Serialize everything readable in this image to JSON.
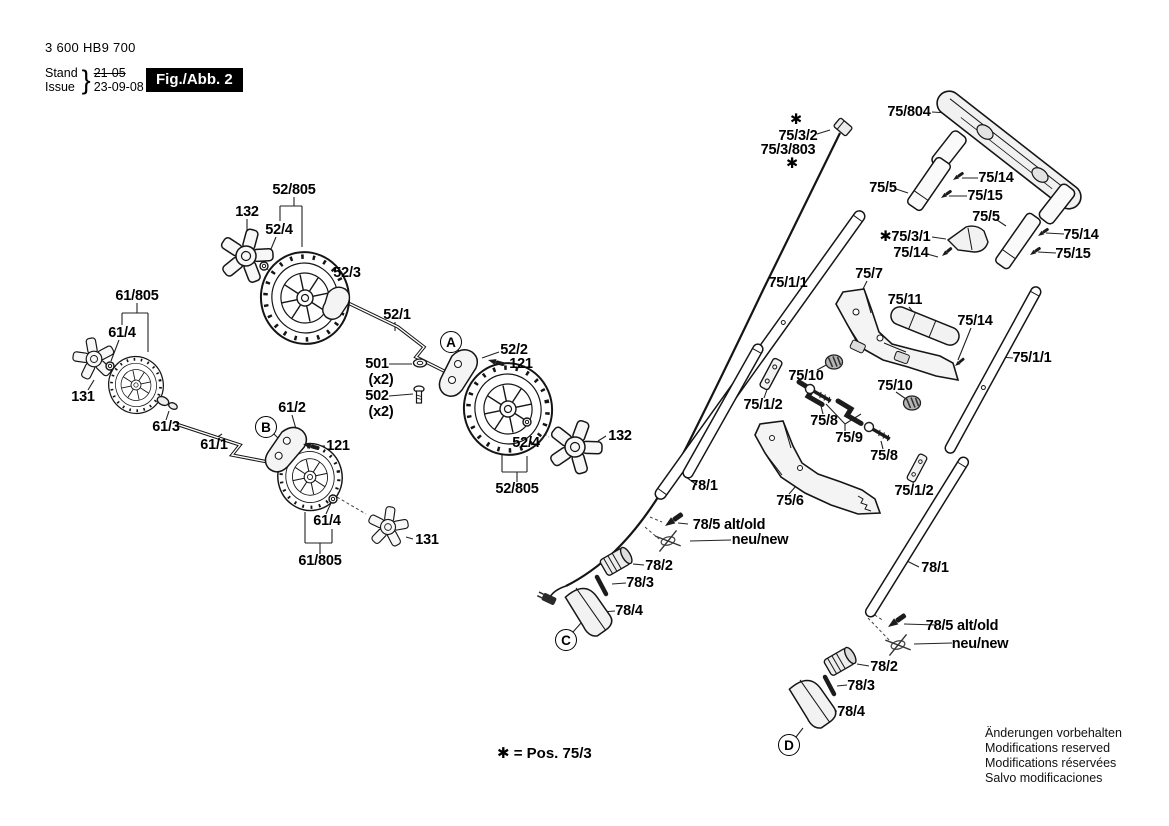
{
  "header": {
    "part_number": "3 600 HB9 700",
    "stand_label": "Stand",
    "issue_label": "Issue",
    "brace": "}",
    "stand_value": "21-05",
    "issue_value": "23-09-08",
    "figure_label": "Fig./Abb. 2"
  },
  "footnote": "✱ = Pos. 75/3",
  "disclaimer": [
    "Änderungen vorbehalten",
    "Modifications reserved",
    "Modifications réservées",
    "Salvo modificaciones"
  ],
  "colors": {
    "ink": "#151515",
    "label_text": "#000000",
    "fig_box_bg": "#000000",
    "fig_box_text": "#ffffff"
  },
  "callouts": [
    {
      "text": "A",
      "x": 451,
      "y": 342
    },
    {
      "text": "B",
      "x": 266,
      "y": 427
    },
    {
      "text": "C",
      "x": 566,
      "y": 640
    },
    {
      "text": "D",
      "x": 789,
      "y": 745
    }
  ],
  "labels": [
    {
      "text": "52/805",
      "x": 294,
      "y": 190
    },
    {
      "text": "132",
      "x": 247,
      "y": 212
    },
    {
      "text": "52/4",
      "x": 279,
      "y": 230
    },
    {
      "text": "52/3",
      "x": 347,
      "y": 273
    },
    {
      "text": "52/1",
      "x": 397,
      "y": 315
    },
    {
      "text": "501",
      "x": 377,
      "y": 364
    },
    {
      "text": "(x2)",
      "x": 381,
      "y": 380
    },
    {
      "text": "502",
      "x": 377,
      "y": 396
    },
    {
      "text": "(x2)",
      "x": 381,
      "y": 412
    },
    {
      "text": "52/2",
      "x": 514,
      "y": 350
    },
    {
      "text": "121",
      "x": 521,
      "y": 364
    },
    {
      "text": "61/805",
      "x": 137,
      "y": 296
    },
    {
      "text": "61/4",
      "x": 122,
      "y": 333
    },
    {
      "text": "131",
      "x": 83,
      "y": 397
    },
    {
      "text": "61/3",
      "x": 166,
      "y": 427
    },
    {
      "text": "61/1",
      "x": 214,
      "y": 445
    },
    {
      "text": "61/2",
      "x": 292,
      "y": 408
    },
    {
      "text": "121",
      "x": 338,
      "y": 446
    },
    {
      "text": "52/4",
      "x": 526,
      "y": 443
    },
    {
      "text": "132",
      "x": 620,
      "y": 436
    },
    {
      "text": "52/805",
      "x": 517,
      "y": 489
    },
    {
      "text": "61/4",
      "x": 327,
      "y": 521
    },
    {
      "text": "131",
      "x": 427,
      "y": 540
    },
    {
      "text": "61/805",
      "x": 320,
      "y": 561
    },
    {
      "text": "✱",
      "x": 796,
      "y": 120
    },
    {
      "text": "75/3/2",
      "x": 798,
      "y": 136
    },
    {
      "text": "75/3/803",
      "x": 788,
      "y": 150
    },
    {
      "text": "✱",
      "x": 792,
      "y": 164
    },
    {
      "text": "75/804",
      "x": 909,
      "y": 112
    },
    {
      "text": "75/5",
      "x": 883,
      "y": 188
    },
    {
      "text": "75/14",
      "x": 996,
      "y": 178
    },
    {
      "text": "75/15",
      "x": 985,
      "y": 196
    },
    {
      "text": "✱75/3/1",
      "x": 905,
      "y": 237
    },
    {
      "text": "75/14",
      "x": 911,
      "y": 253
    },
    {
      "text": "75/5",
      "x": 986,
      "y": 217
    },
    {
      "text": "75/14",
      "x": 1081,
      "y": 235
    },
    {
      "text": "75/15",
      "x": 1073,
      "y": 254
    },
    {
      "text": "75/1/1",
      "x": 788,
      "y": 283
    },
    {
      "text": "75/7",
      "x": 869,
      "y": 274
    },
    {
      "text": "75/11",
      "x": 905,
      "y": 300
    },
    {
      "text": "75/14",
      "x": 975,
      "y": 321
    },
    {
      "text": "75/1/1",
      "x": 1032,
      "y": 358
    },
    {
      "text": "75/10",
      "x": 806,
      "y": 376
    },
    {
      "text": "75/10",
      "x": 895,
      "y": 386
    },
    {
      "text": "75/1/2",
      "x": 763,
      "y": 405
    },
    {
      "text": "75/8",
      "x": 824,
      "y": 421
    },
    {
      "text": "75/9",
      "x": 849,
      "y": 438
    },
    {
      "text": "75/8",
      "x": 884,
      "y": 456
    },
    {
      "text": "78/1",
      "x": 704,
      "y": 486
    },
    {
      "text": "75/6",
      "x": 790,
      "y": 501
    },
    {
      "text": "75/1/2",
      "x": 914,
      "y": 491
    },
    {
      "text": "78/5 alt/old",
      "x": 729,
      "y": 525
    },
    {
      "text": "neu/new",
      "x": 760,
      "y": 540
    },
    {
      "text": "78/2",
      "x": 659,
      "y": 566
    },
    {
      "text": "78/3",
      "x": 640,
      "y": 583
    },
    {
      "text": "78/4",
      "x": 629,
      "y": 611
    },
    {
      "text": "78/1",
      "x": 935,
      "y": 568
    },
    {
      "text": "78/5 alt/old",
      "x": 962,
      "y": 626
    },
    {
      "text": "neu/new",
      "x": 980,
      "y": 644
    },
    {
      "text": "78/2",
      "x": 884,
      "y": 667
    },
    {
      "text": "78/3",
      "x": 861,
      "y": 686
    },
    {
      "text": "78/4",
      "x": 851,
      "y": 712
    }
  ]
}
